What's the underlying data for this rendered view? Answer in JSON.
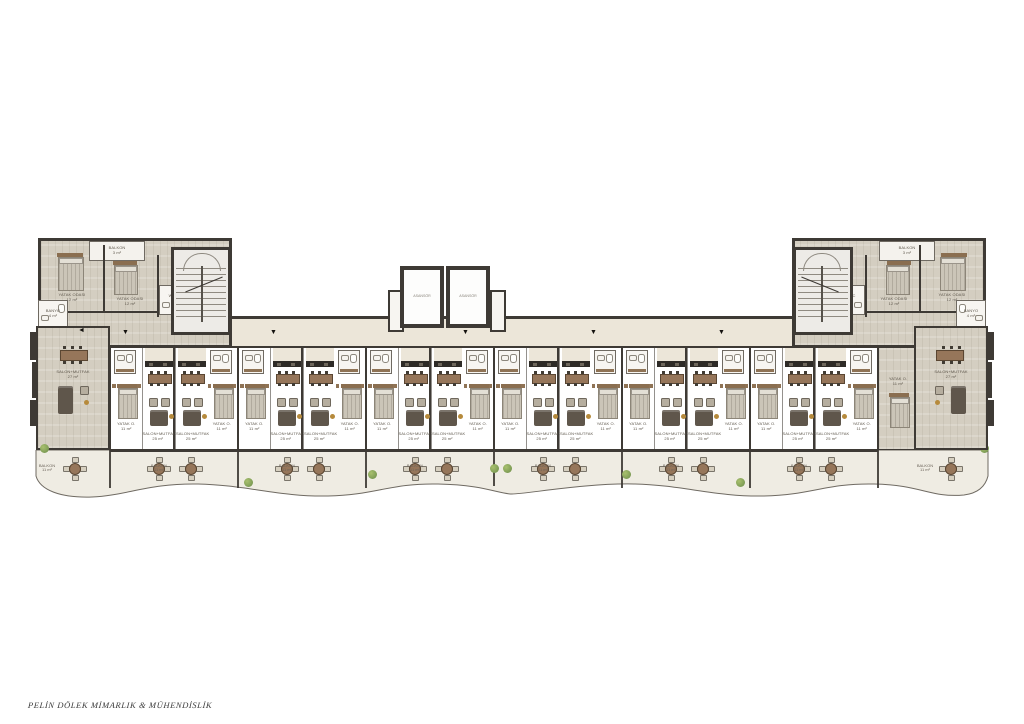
{
  "title_block": {
    "signature": "PELİN DÖLEK MİMARLIK & MÜHENDİSLİK"
  },
  "colors": {
    "wall": "#3e3a35",
    "wood_floor": "#d4cec1",
    "corridor_floor": "#ece6d9",
    "balcony_floor": "#efece3",
    "stair_floor": "#edebe7",
    "bath_floor": "#f7f5f1",
    "furniture_brown": "#8f7355",
    "furniture_dark": "#5f564b",
    "table_wood": "#96765a",
    "armchair": "#b6ae9f",
    "bed_mattress": "#cbc5b8",
    "bed_head": "#8a6e50",
    "plant_green": "#7d9c55",
    "gold": "#b68a3c",
    "outline": "#6f6a62"
  },
  "labels": {
    "living": "SALON+MUTFAK",
    "living_area": "25 m²",
    "living_end_area": "27 m²",
    "bedroom": "YATAK O.",
    "bedroom_area": "11 m²",
    "bedroom_main": "YATAK ODASI",
    "bedroom_main_area": "12 m²",
    "bathroom": "BANYO",
    "bathroom_area": "4 m²",
    "wc": "WC",
    "hall": "HOL",
    "hall_area": "4 m²",
    "balcony": "BALKON",
    "balcony_area": "11 m²",
    "balcony_top_area": "3 m²",
    "stairs": "MERDİVEN",
    "elevator": "ASANSÖR"
  },
  "plan": {
    "middle_unit_count": 12,
    "down_arrow_x": [
      122,
      270,
      462,
      590,
      718,
      846,
      902
    ],
    "left_arrow_x": 78,
    "right_arrow_x": 946
  }
}
